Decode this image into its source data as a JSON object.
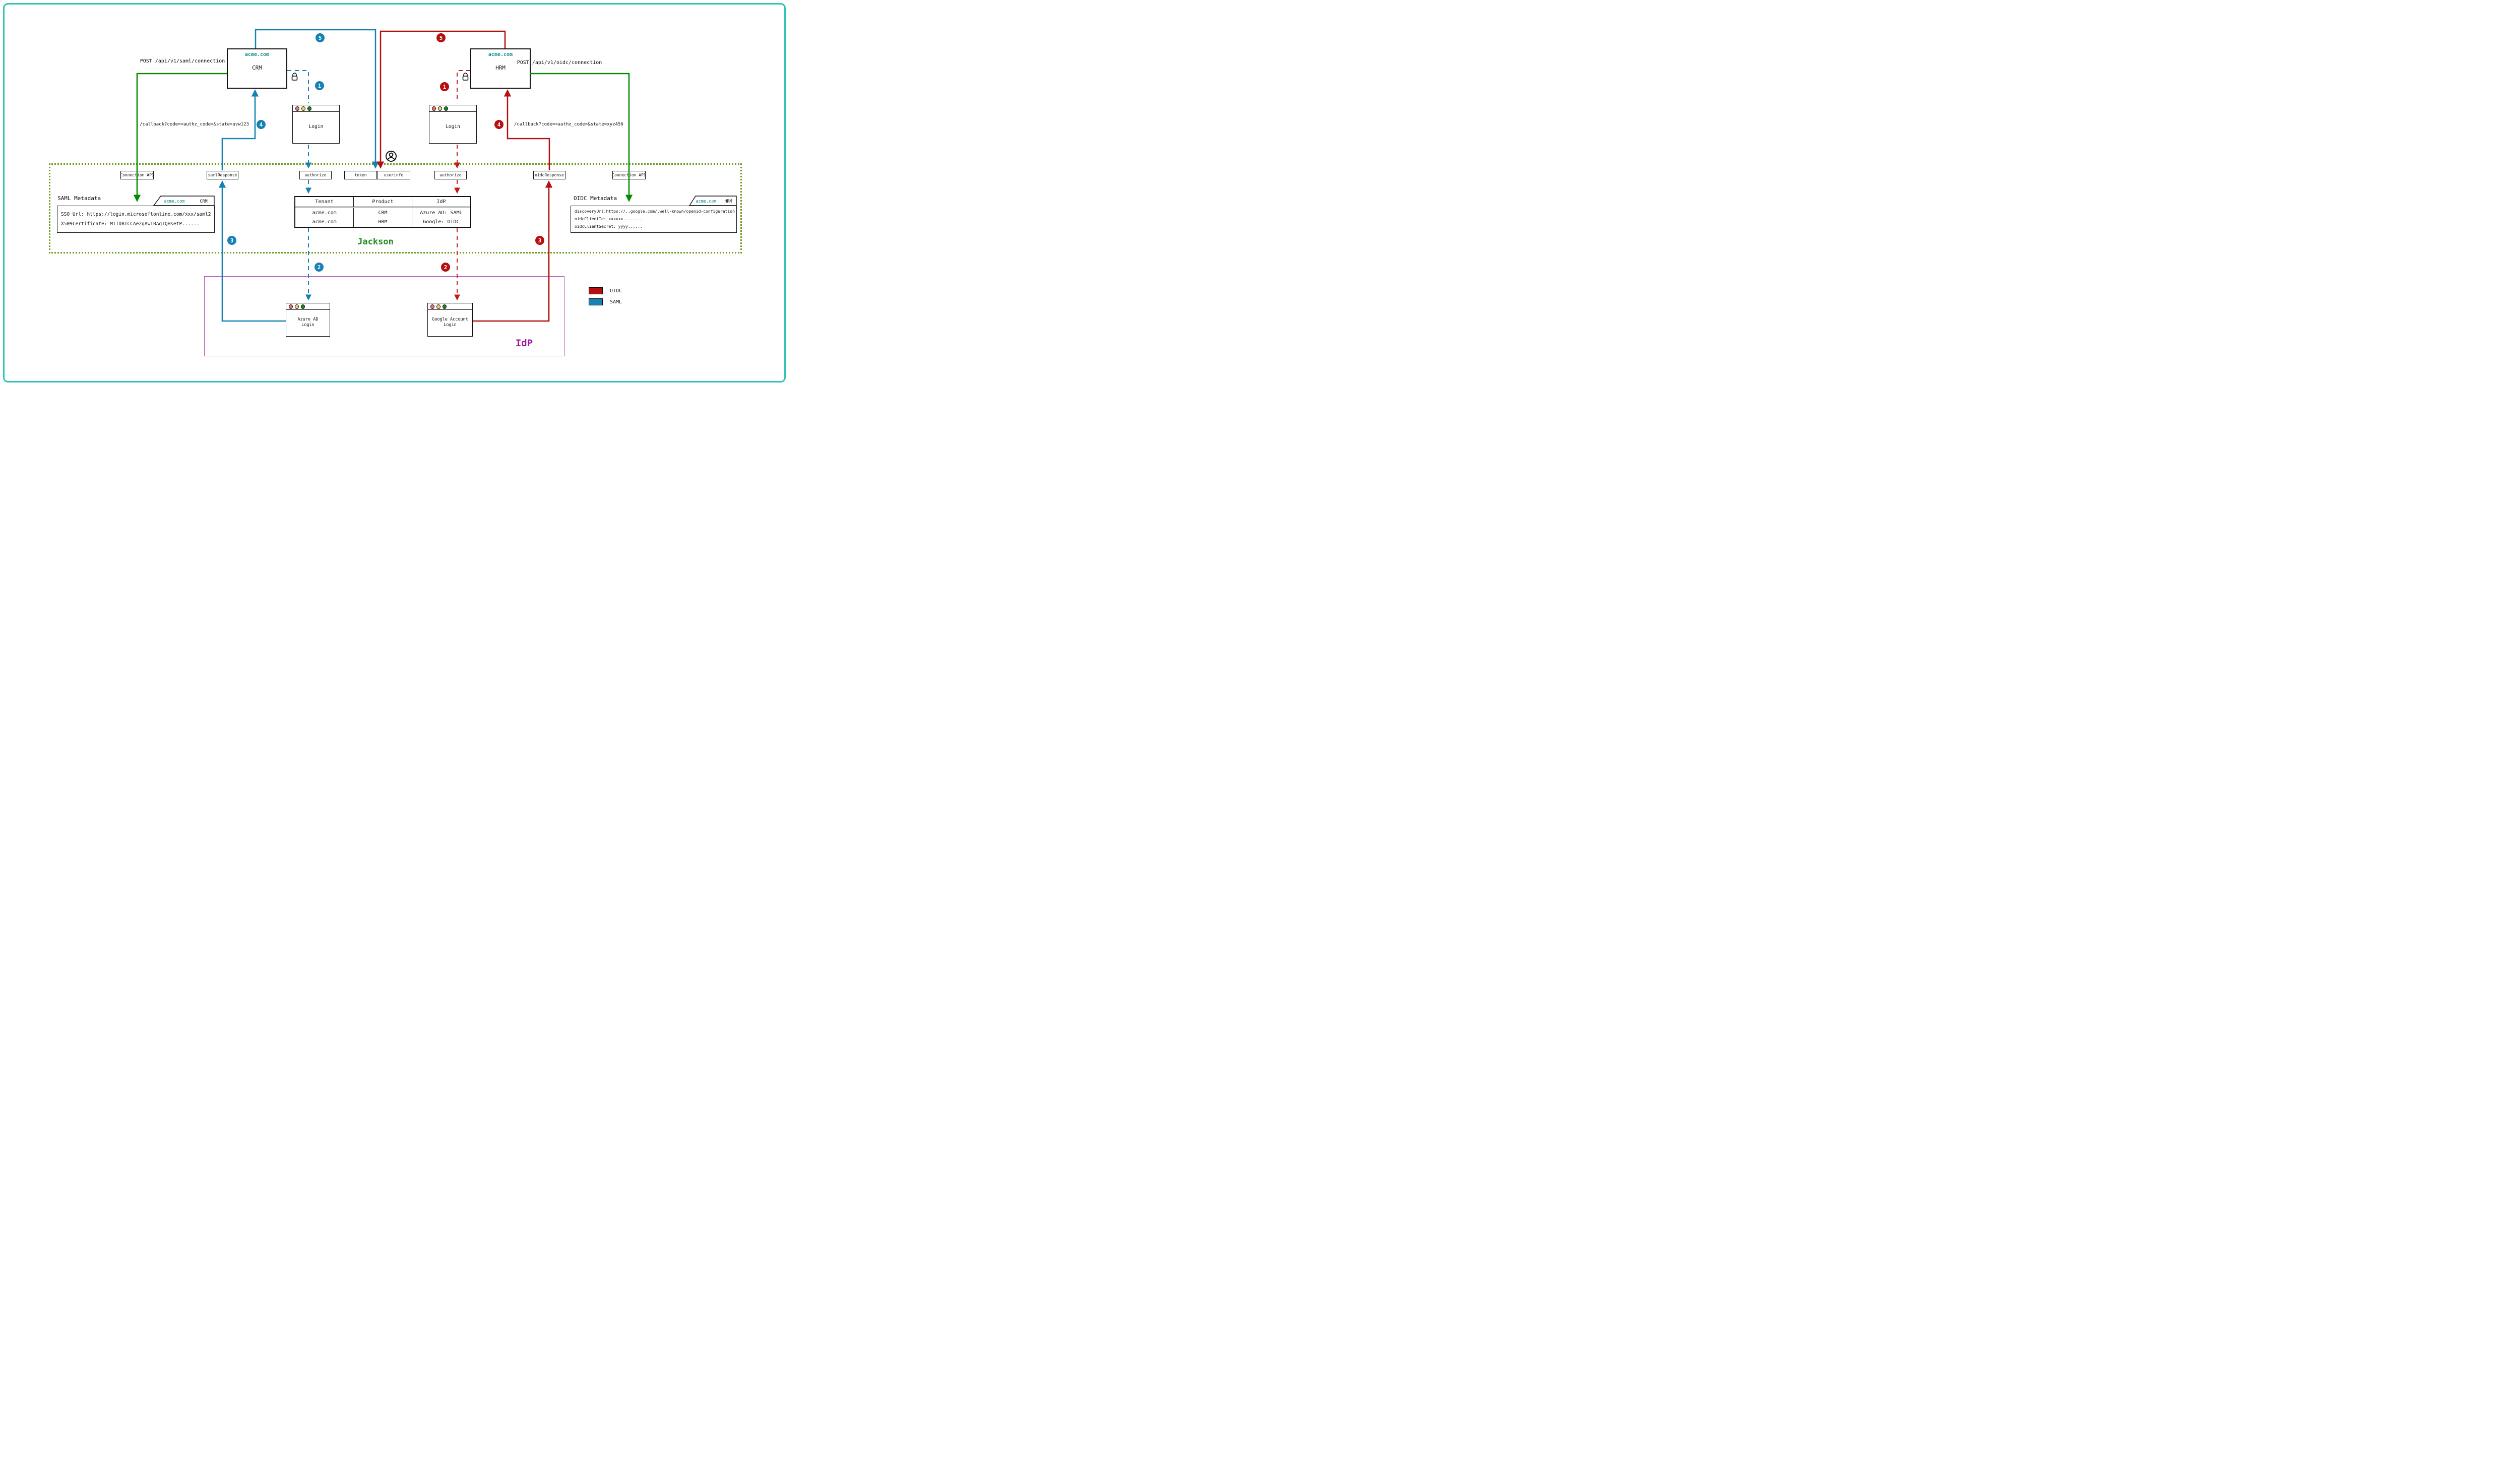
{
  "apps": {
    "crm": {
      "domain": "acme.com",
      "name": "CRM"
    },
    "hrm": {
      "domain": "acme.com",
      "name": "HRM"
    }
  },
  "api_labels": {
    "saml_post": "POST /api/v1/saml/connection",
    "oidc_post": "POST /api/v1/oidc/connection",
    "saml_callback": "/callback?code=<authz_code>&state=uvw123",
    "oidc_callback": "/callback?code=<authz_code>&state=xyz456"
  },
  "endpoints": {
    "connection_api_left": "Connection API",
    "saml_response": "samlResponse",
    "authorize_left": "authorize",
    "token": "token",
    "userinfo": "userinfo",
    "authorize_right": "authorize",
    "oidc_response": "oidcResponse",
    "connection_api_right": "Connection API"
  },
  "login_windows": {
    "sp_left": "Login",
    "sp_right": "Login",
    "idp_left": "Azure AD Login",
    "idp_right": "Google Account Login"
  },
  "saml_metadata": {
    "title": "SAML Metadata",
    "tab_domain": "acme.com",
    "tab_product": "CRM",
    "lines": [
      "SSO Url: https://login.microsoftonline.com/xxx/saml2",
      "X509Certificate: MIIDBTCCAe2gAwIBAgIQHsetP......"
    ]
  },
  "oidc_metadata": {
    "title": "OIDC Metadata",
    "tab_domain": "acme.com",
    "tab_product": "HRM",
    "lines": [
      "discoveryUrl:https://..google.com/.well-known/openid-configuration",
      "oidcClientId: xxxxxx........",
      "oidcClientSecret: yyyy......"
    ]
  },
  "connections_table": {
    "headers": [
      "Tenant",
      "Product",
      "IdP"
    ],
    "rows": [
      [
        "acme.com",
        "CRM",
        "Azure AD: SAML"
      ],
      [
        "acme.com",
        "HRM",
        "Google: OIDC"
      ]
    ]
  },
  "labels": {
    "jackson": "Jackson",
    "idp": "IdP"
  },
  "legend": [
    {
      "label": "OIDC",
      "color": "#b50f0f"
    },
    {
      "label": "SAML",
      "color": "#1681b2"
    }
  ],
  "steps": {
    "one": "1",
    "two": "2",
    "three": "3",
    "four": "4",
    "five": "5"
  },
  "colors": {
    "page_border": "#2ec4b6",
    "jackson_border": "#6f9b1f",
    "jackson_text": "#1f8b1f",
    "idp_border": "#b44ab4",
    "idp_text": "#9b1b9b",
    "saml_flow": "#1681b2",
    "oidc_flow": "#b50f0f",
    "oidc_flow_dashed": "#c11b1b",
    "connection_api_flow": "#008b00",
    "domain_text": "#0d8d8d"
  }
}
